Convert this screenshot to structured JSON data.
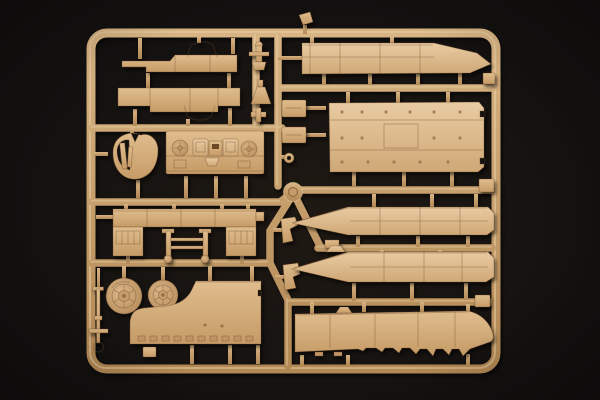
{
  "scene": {
    "type": "photograph",
    "subject": "Injection-molded plastic model-kit sprue (runner frame) with tan parts on a black backdrop",
    "background_style": "near-black with faint warm center glow and corner vignette"
  },
  "palette": {
    "bg": "#131110",
    "plastic_light": "#e0bd8e",
    "plastic_dark": "#c298622",
    "plastic_base": "#d3ab7a",
    "plastic_bright_light": "#e9cba2",
    "plastic_bright_dark": "#cfa876",
    "plastic_outline": "#6e4b2a",
    "detail_dark": "#a07c4e",
    "rail_base": "#c99e6a",
    "rail_light": "#d8b484",
    "rail_dark": "#b28854",
    "rail_highlight": "#ecd2a6",
    "wheel_center": "#dcb88a",
    "wheel_edge": "#b28756"
  },
  "parts_inventory": [
    {
      "id": "chassis-strip-top",
      "desc": "long stepped strip with octagonal ring guard above"
    },
    {
      "id": "chassis-strip-lower",
      "desc": "long stepped strip with octagonal ring guard below"
    },
    {
      "id": "shackle-fitting",
      "desc": "small cross-shaped fitting"
    },
    {
      "id": "funnel-fitting",
      "desc": "small trapezoid funnel fitting"
    },
    {
      "id": "tee-fitting",
      "desc": "small T fitting"
    },
    {
      "id": "mount-block-upper",
      "desc": "small rectangular block"
    },
    {
      "id": "mount-block-lower",
      "desc": "small rectangular block"
    },
    {
      "id": "ring-eyelet",
      "desc": "tiny ringed eyelet"
    },
    {
      "id": "heart-panel",
      "desc": "rounded shield-shaped panel with inner cutout and levers"
    },
    {
      "id": "engine-deck",
      "desc": "engine deck with round and square bosses"
    },
    {
      "id": "fender-unit",
      "desc": "U-shaped fender assembly with side pads"
    },
    {
      "id": "axle-frame",
      "desc": "twin-rod axle frame with cross bars"
    },
    {
      "id": "road-wheel-large",
      "desc": "spoked drum wheel"
    },
    {
      "id": "road-wheel-small",
      "desc": "spoked drum wheel"
    },
    {
      "id": "notched-floor-panel",
      "desc": "large panel with concave corner notch"
    },
    {
      "id": "tow-rod",
      "desc": "thin rod with end ring"
    },
    {
      "id": "periscope-bracket-1",
      "desc": "small angled bracket"
    },
    {
      "id": "periscope-bracket-2",
      "desc": "small angled bracket"
    },
    {
      "id": "hull-deck-tapered",
      "desc": "long deck strip tapering to a point at right"
    },
    {
      "id": "roof-panel-large",
      "desc": "large rectangular roof panel with rivet texture"
    },
    {
      "id": "hull-side-upper",
      "desc": "long strip pointed at left end"
    },
    {
      "id": "hull-side-lower",
      "desc": "long strip pointed at left end with top lug"
    },
    {
      "id": "hull-side-toothed",
      "desc": "long hull strip with toothed lower edge and rounded nose"
    },
    {
      "id": "sprue-frame",
      "desc": "rounded rectangular runner frame with internal runners, hub and gates"
    }
  ]
}
